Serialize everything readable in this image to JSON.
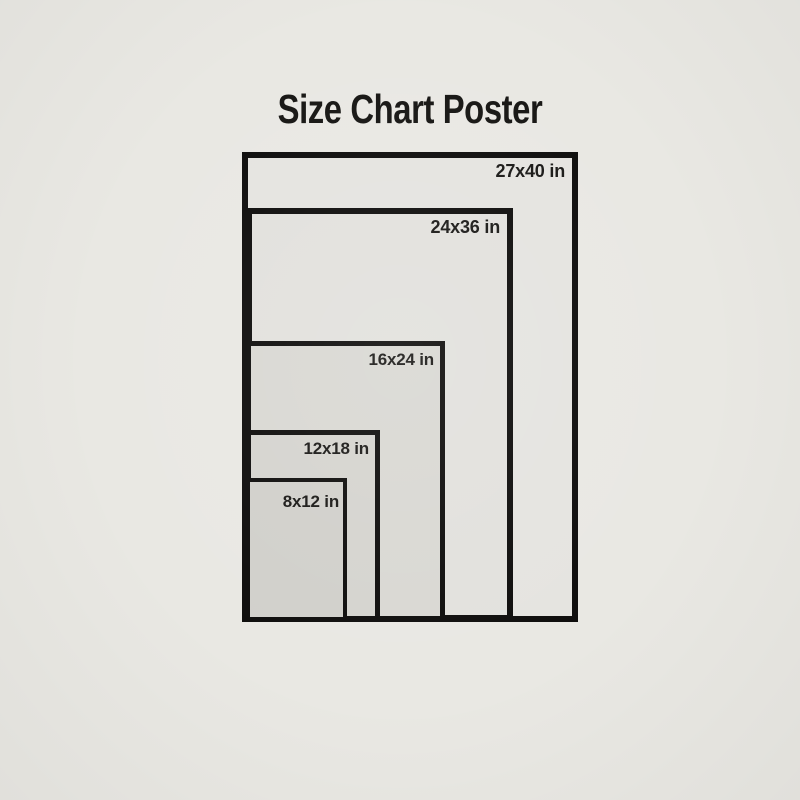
{
  "header": {
    "title": "Size Chart Poster"
  },
  "sizes": [
    {
      "label": "27x40 in",
      "width_in": 27,
      "height_in": 40
    },
    {
      "label": "24x36 in",
      "width_in": 24,
      "height_in": 36
    },
    {
      "label": "16x24 in",
      "width_in": 16,
      "height_in": 24
    },
    {
      "label": "12x18 in",
      "width_in": 12,
      "height_in": 18
    },
    {
      "label": "8x12 in",
      "width_in": 8,
      "height_in": 12
    }
  ],
  "colors": {
    "page_background": "#e9e8e3",
    "border": "#0e0d0c",
    "title_text": "#161513",
    "label_text": "#191816",
    "fill_27x40": "#e5e4e0",
    "fill_24x36": "#e2e1dd",
    "fill_16x24": "#d9d8d3",
    "fill_12x18": "#d5d4cf",
    "fill_8x12": "#d1d0cb"
  }
}
